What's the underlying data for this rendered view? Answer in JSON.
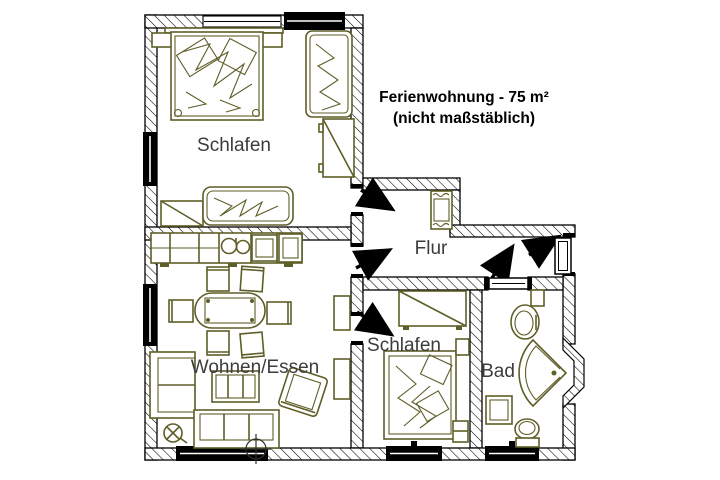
{
  "title": {
    "line1": "Ferienwohnung - 75 m²",
    "line2": "(nicht maßstäblich)"
  },
  "rooms": {
    "bedroom1": {
      "label": "Schlafen"
    },
    "hallway": {
      "label": "Flur"
    },
    "living_dining": {
      "label": "Wohnen/Essen"
    },
    "bedroom2": {
      "label": "Schlafen"
    },
    "bathroom": {
      "label": "Bad"
    }
  },
  "colors": {
    "background": "#ffffff",
    "walls": "#000000",
    "furniture": "#5e5e28",
    "room_label": "#3c3c3c",
    "title_text": "#000000"
  },
  "icons": [
    "double-bed-icon",
    "single-bed-icon",
    "nightstand-icon",
    "wardrobe-icon",
    "dresser-icon",
    "kitchen-counter-icon",
    "kitchen-sink-icon",
    "stove-icon",
    "fridge-icon",
    "dining-table-icon",
    "chair-icon",
    "corner-sofa-icon",
    "coffee-table-icon",
    "armchair-icon",
    "floor-lamp-icon",
    "tv-board-icon",
    "ceiling-light-icon",
    "hall-cabinet-icon",
    "washbasin-icon",
    "corner-shower-icon",
    "toilet-icon",
    "washing-machine-icon",
    "door-swing-arrow-icon",
    "entrance-door-icon",
    "window-icon"
  ]
}
